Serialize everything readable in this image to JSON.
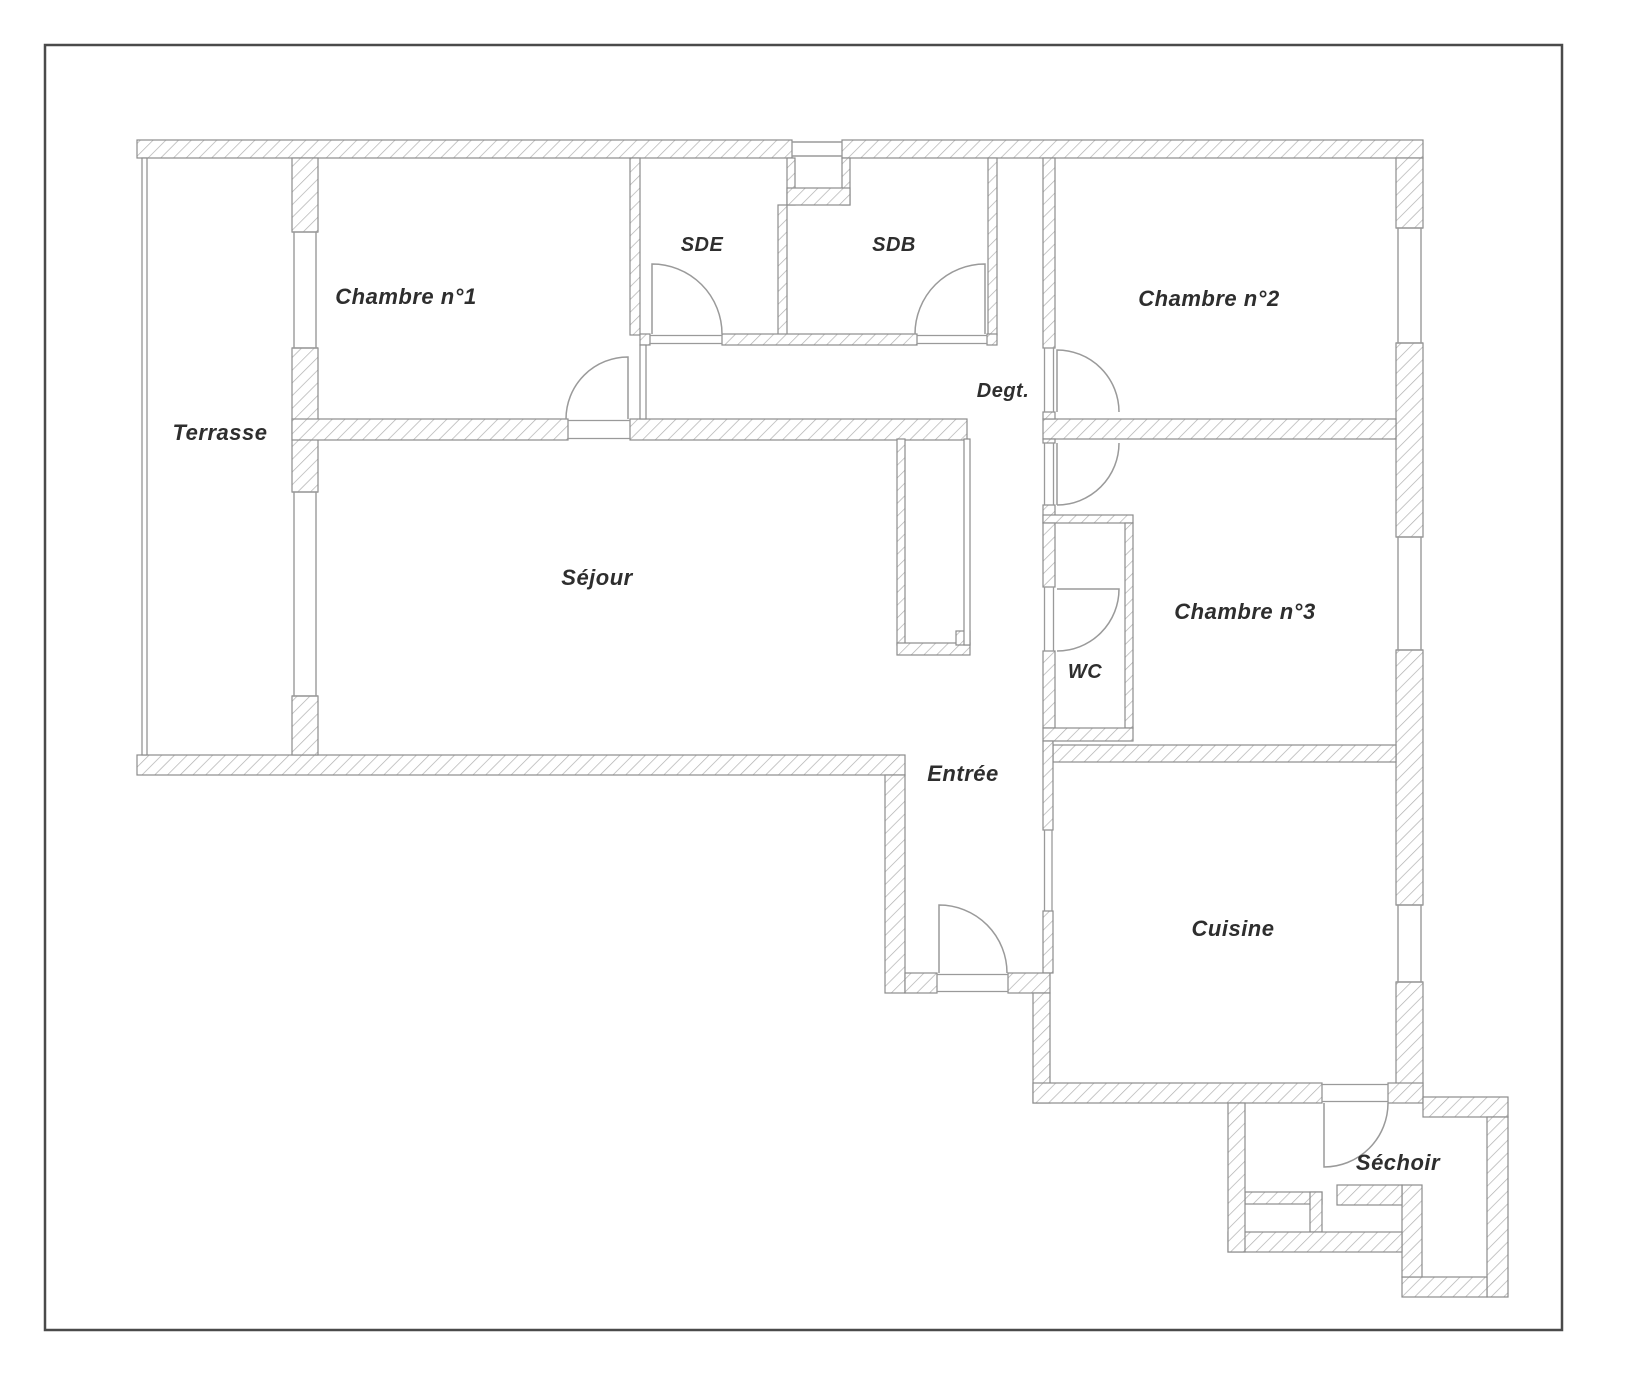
{
  "figure": {
    "type": "floor-plan",
    "language": "fr"
  },
  "colors": {
    "paper": "#ffffff",
    "page_border": "#4a4a4a",
    "wall_outline": "#8c8c8c",
    "hatch_stripe": "#b0b0b0",
    "door_window_stroke": "#9a9a9a",
    "label_text": "#2e2e2e"
  },
  "rooms": {
    "terrasse": {
      "label": "Terrasse"
    },
    "chambre1": {
      "label": "Chambre n°1"
    },
    "sde": {
      "label": "SDE"
    },
    "sdb": {
      "label": "SDB"
    },
    "chambre2": {
      "label": "Chambre n°2"
    },
    "degt": {
      "label": "Degt."
    },
    "sejour": {
      "label": "Séjour"
    },
    "wc": {
      "label": "WC"
    },
    "chambre3": {
      "label": "Chambre n°3"
    },
    "entree": {
      "label": "Entrée"
    },
    "cuisine": {
      "label": "Cuisine"
    },
    "sechoir": {
      "label": "Séchoir"
    }
  }
}
